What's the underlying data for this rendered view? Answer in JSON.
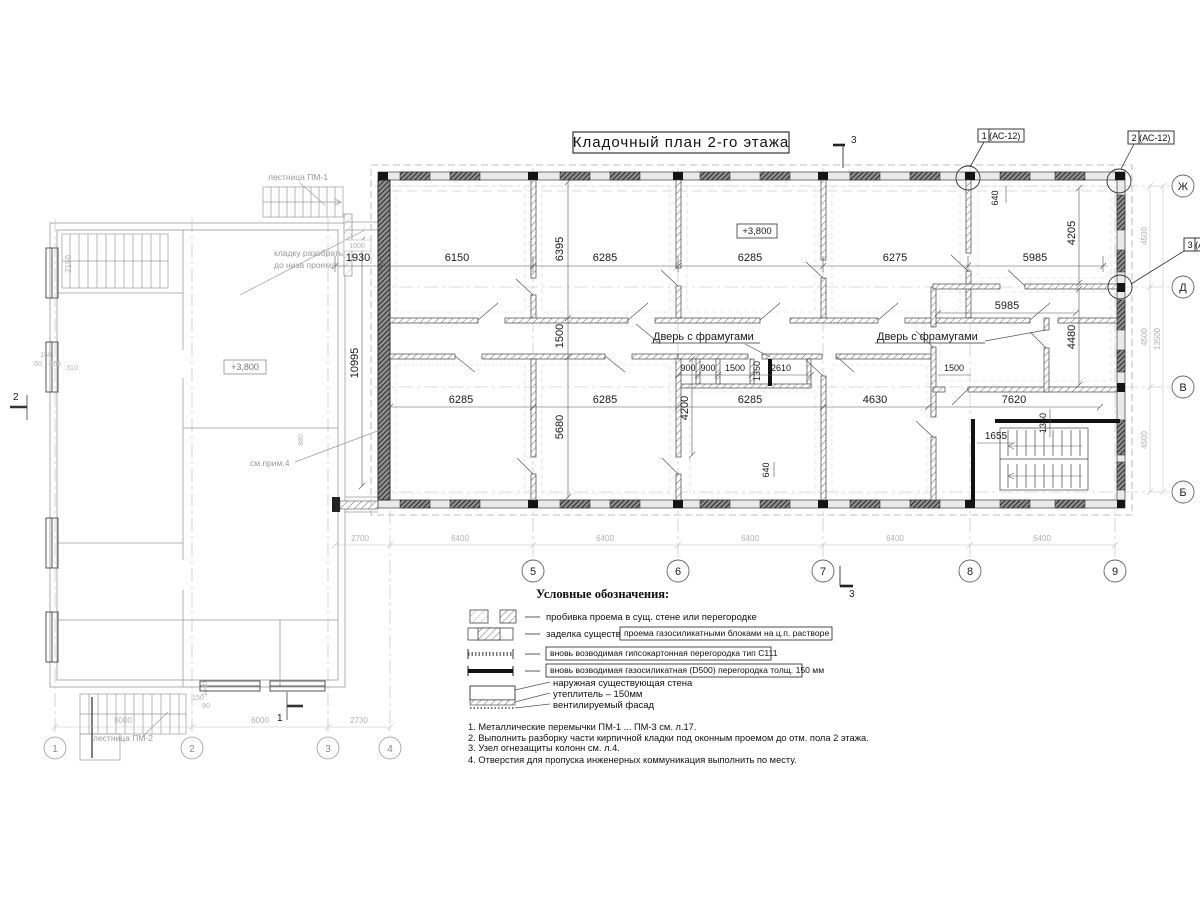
{
  "title": "Кладочный план 2-го этажа",
  "plan": {
    "level_mark": "+3,800",
    "door_label": "Дверь с фрамугами",
    "callout_1": "1 (АС-12)",
    "callout_2": "2 (АС-12)",
    "callout_3": "3 (АС-12)",
    "section_3": "3",
    "section_1": "1",
    "section_2": "2",
    "axes_bottom": [
      "5",
      "6",
      "7",
      "8",
      "9"
    ],
    "axes_right": [
      "Ж",
      "Д",
      "В",
      "Б"
    ],
    "dims_top": [
      "1930",
      "6150",
      "6285",
      "6285",
      "6275",
      "5985"
    ],
    "dims_mid": [
      "6285",
      "6285",
      "6285",
      "4630",
      "7620"
    ],
    "dims_toilet": [
      "900",
      "900",
      "1500",
      "2610"
    ],
    "dim_1350": "1350",
    "dim_1500_right": "1500",
    "dim_5985_right": "5985",
    "dim_10995": "10995",
    "dim_6395": "6395",
    "dim_1500_corr": "1500",
    "dim_5680": "5680",
    "dim_4200": "4200",
    "dim_640": "640",
    "dim_4205": "4205",
    "dim_4480": "4480",
    "dim_1360": "1360",
    "dim_1655": "1655",
    "dims_bottom_grey": [
      "2700",
      "6400",
      "6400",
      "6400",
      "6400",
      "6400"
    ],
    "dims_right_grey": [
      "4500",
      "4500",
      "4500",
      "13500"
    ]
  },
  "left_building": {
    "level_mark": "+3,800",
    "stair_pm1": "лестница ПМ-1",
    "stair_pm2": "лестница ПМ-2",
    "demolish_note_1": "кладку разобрать",
    "demolish_note_2": "до низа проема",
    "see_note": "см.прим.4",
    "axes_bottom": [
      "1",
      "2",
      "3",
      "4"
    ],
    "dims_bottom_grey": [
      "6000",
      "6000",
      "2730"
    ],
    "dim_2150": "2150",
    "dim_880": "880",
    "dim_1000": "1000",
    "dims_small": [
      "150",
      "60",
      "300",
      "310"
    ],
    "dims_small2": [
      "1440",
      "150",
      "90"
    ]
  },
  "legend": {
    "heading": "Условные обозначения:",
    "row1": "пробивка проема  в сущ. стене  или перегородке",
    "row2_prefix": "заделка существ.",
    "row2_boxed": "проема газосиликатными блоками на ц.п. растворе",
    "row3_boxed": "вновь возводимая гипсокартонная перегородка тип С111",
    "row4_boxed": "вновь возводимая газосиликатная (D500) перегородка толщ. 150 мм",
    "row5_line1": "наружная существующая стена",
    "row5_line2": "утеплитель – 150мм",
    "row5_line3": "вентилируемый фасад"
  },
  "notes": {
    "n1": "1. Металлические перемычки  ПМ-1 ... ПМ-3 см. л.17.",
    "n2": "2. Выполнить разборку части кирпичной кладки под оконным проемом до отм. пола 2 этажа.",
    "n3": "3. Узел огнезащиты колонн см. л.4.",
    "n4": "4. Отверстия для пропуска инженерных коммуникация выполнить по месту."
  }
}
